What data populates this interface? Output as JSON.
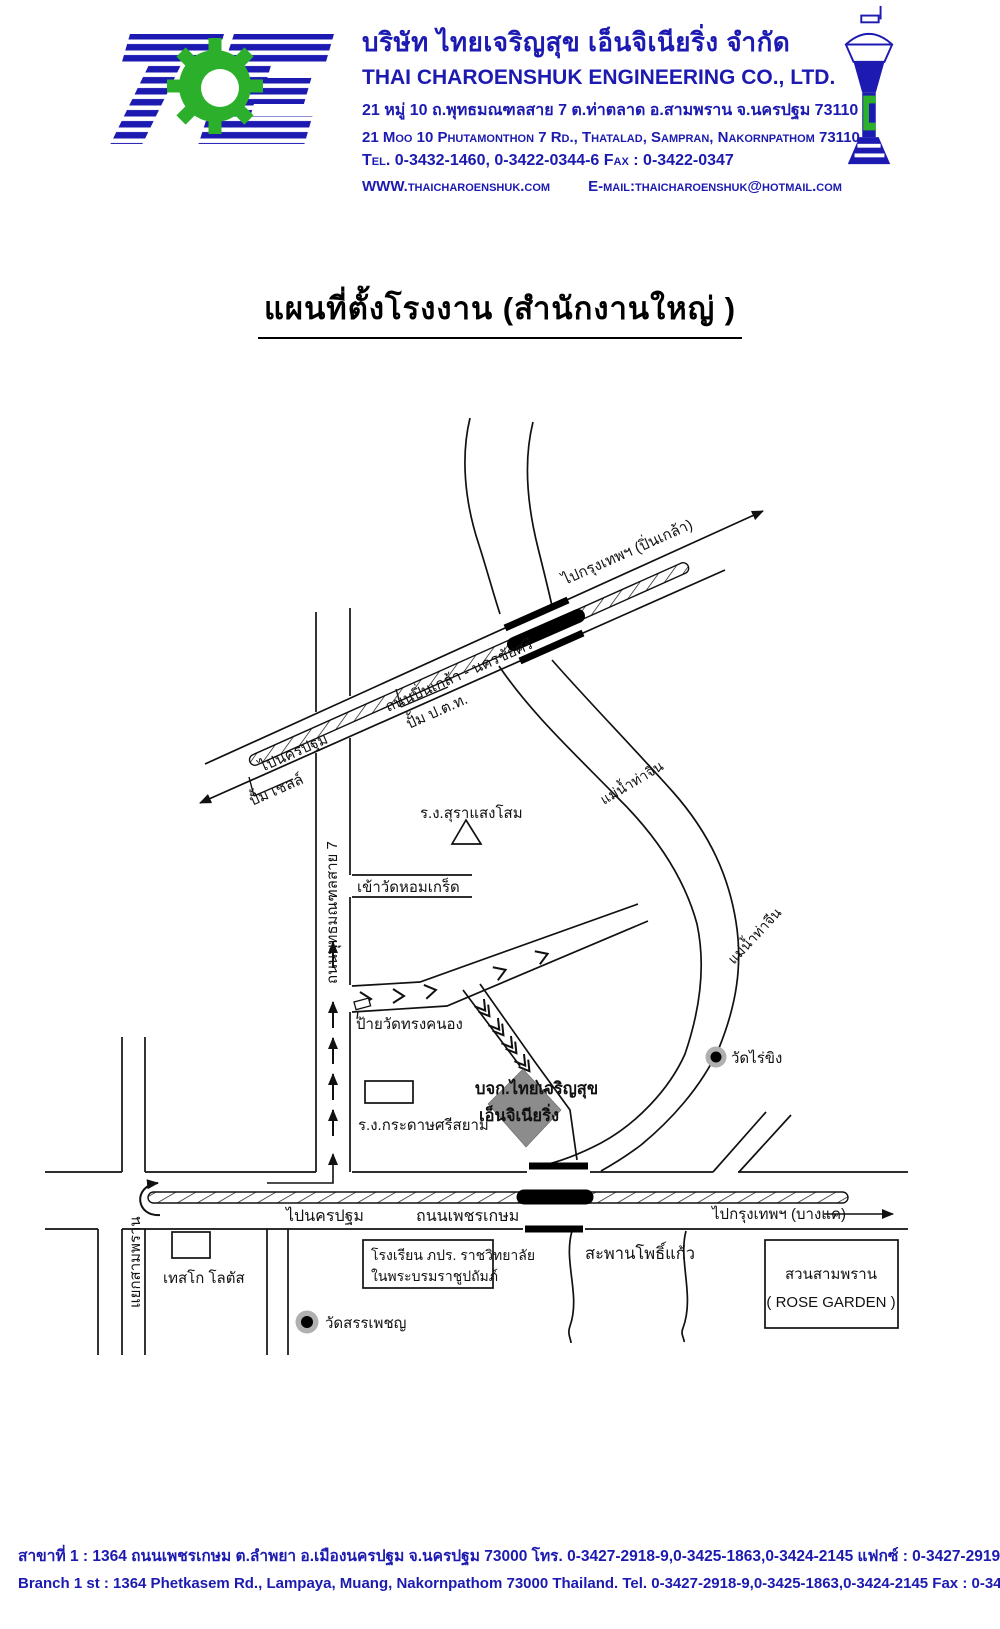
{
  "header": {
    "company_th": "บริษัท ไทยเจริญสุข  เอ็นจิเนียริ่ง  จำกัด",
    "company_en": "THAI  CHAROENSHUK  ENGINEERING  CO.,  LTD.",
    "address_th": "21 หมู่ 10 ถ.พุทธมณฑลสาย 7 ต.ท่าตลาด อ.สามพราน จ.นครปฐม 73110",
    "address_en": "21 Moo 10 Phutamonthon 7 Rd., Thatalad, Sampran, Nakornpathom 73110",
    "tel_fax": "Tel. 0-3432-1460, 0-3422-0344-6   Fax : 0-3422-0347",
    "website": "WWW.thaicharoenshuk.com",
    "email": "E-mail:thaicharoenshuk@hotmail.com"
  },
  "title": "แผนที่ตั้งโรงงาน (สำนักงานใหญ่ )",
  "map": {
    "labels": {
      "to_bangkok_pinklao": "ไปกรุงเทพฯ (ปิ่นเกล้า)",
      "pinklao_road": "ถนนปิ่นเกล้า - นครชัยศรี",
      "to_nakhonpathom_upper": "ไปนครปฐม",
      "ptt_station": "ปั้ม ป.ต.ท.",
      "shell_station": "ปั้ม เชลล์",
      "sangsom_factory": "ร.ง.สุราแสงโสม",
      "wat_homkret_entrance": "เข้าวัดหอมเกร็ด",
      "phutthamonthon_road": "ถนนพุทธมณฑลสาย 7",
      "wat_songkhanong_sign": "ป้ายวัดทรงคนอง",
      "sisiam_paper_factory": "ร.ง.กระดาษศรีสยาม",
      "company_line1": "บจก.ไทยเจริญสุข",
      "company_line2": "เอ็นจิเนียริ่ง",
      "wat_raikhing": "วัดไร่ขิง",
      "thachin_river_1": "แม่น้ำท่าจีน",
      "thachin_river_2": "แม่น้ำท่าจีน",
      "to_nakhonpathom_lower": "ไปนครปฐม",
      "phetkasem_road": "ถนนเพชรเกษม",
      "to_bangkok_bangkae": "ไปกรุงเทพฯ (บางแค)",
      "samphran_junction": "แยกสามพราน",
      "tesco_lotus": "เทสโก โลตัส",
      "school_line1": "โรงเรียน ภปร. ราชวิทยาลัย",
      "school_line2": "ในพระบรมราชูปถัมภ์",
      "wat_sanphet": "วัดสรรเพชญ",
      "phokaew_bridge": "สะพานโพธิ์แก้ว",
      "rose_garden_th": "สวนสามพราน",
      "rose_garden_en": "( ROSE GARDEN )"
    }
  },
  "footer": {
    "branch_th": "สาขาที่ 1   :  1364 ถนนเพชรเกษม ต.ลำพยา อ.เมืองนครปฐม จ.นครปฐม 73000    โทร. 0-3427-2918-9,0-3425-1863,0-3424-2145    แฟกซ์ : 0-3427-2919",
    "branch_en": "Branch 1 st :  1364 Phetkasem Rd.,  Lampaya,  Muang,  Nakornpathom 73000 Thailand.    Tel. 0-3427-2918-9,0-3425-1863,0-3424-2145        Fax : 0-3427-2919"
  },
  "colors": {
    "brand_blue": "#1c1ab0",
    "gear_green": "#2cb02c",
    "building_gray": "#8c8c8c",
    "map_line": "#111111"
  }
}
